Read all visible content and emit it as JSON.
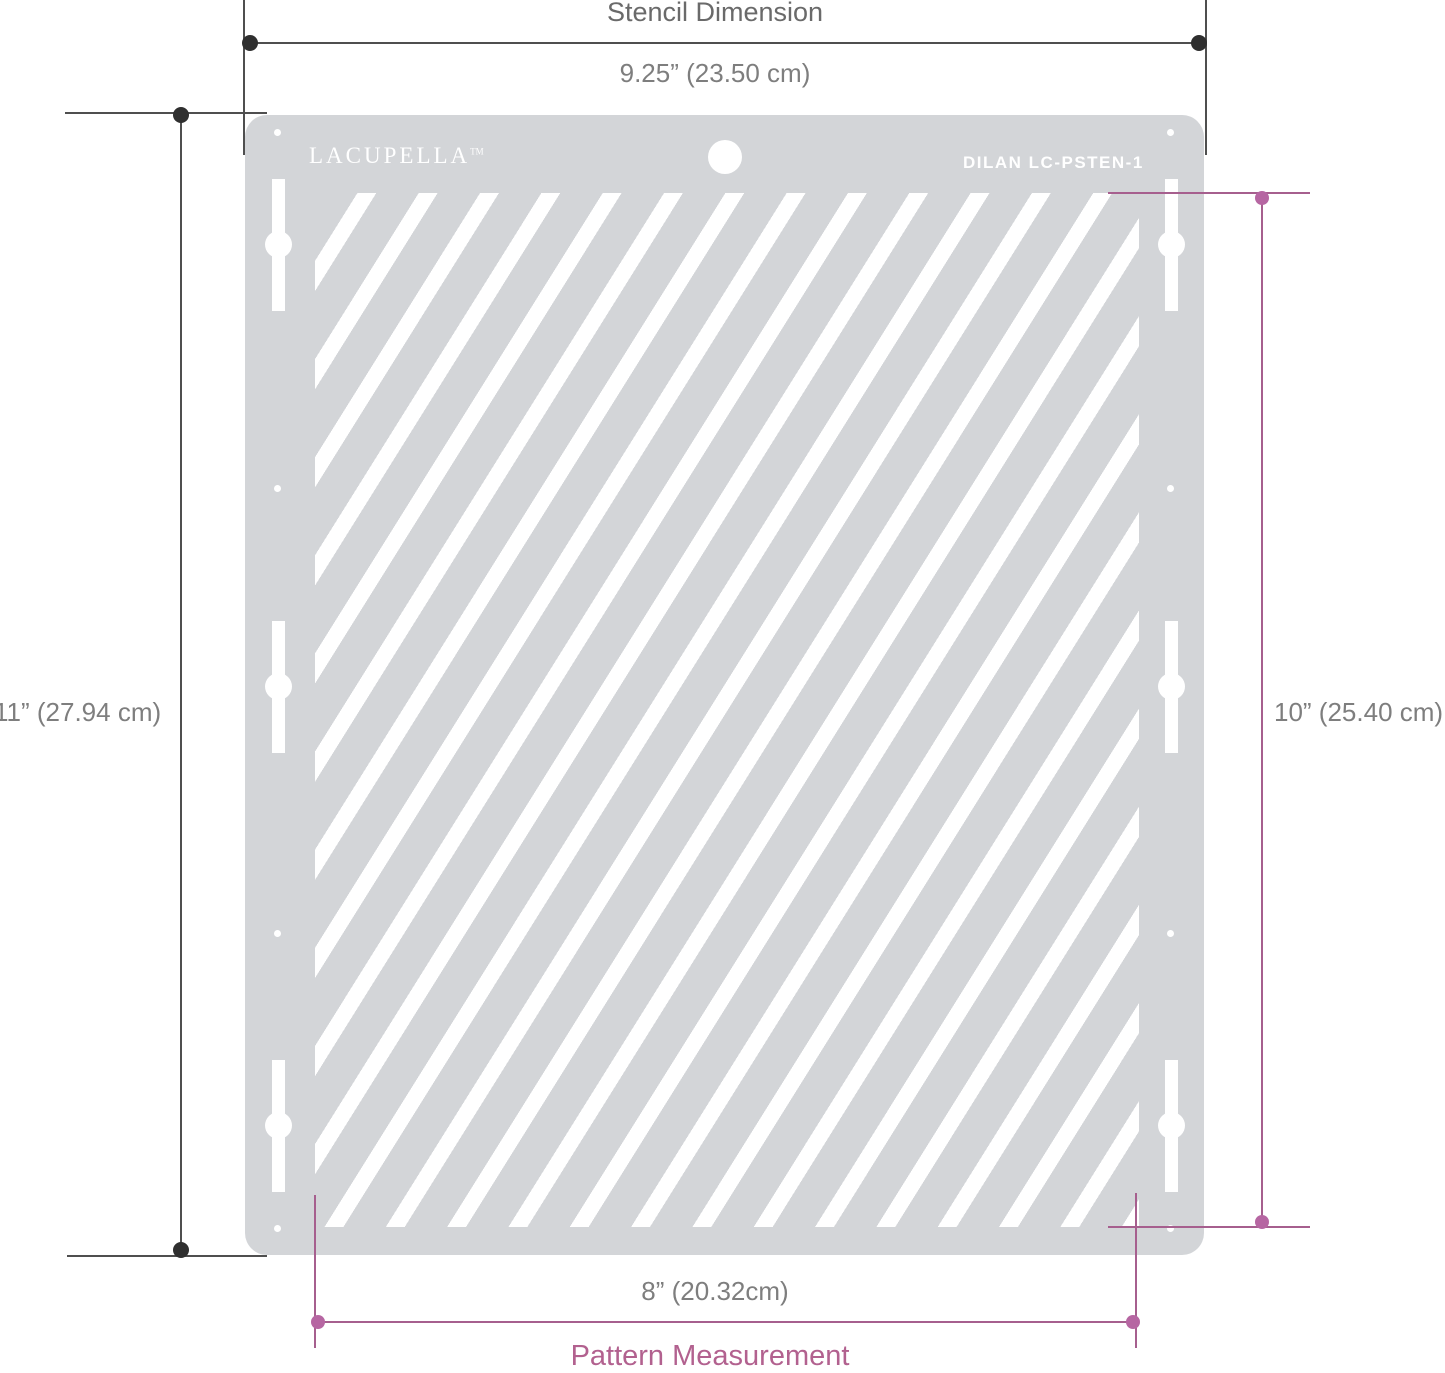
{
  "diagram": {
    "type": "product-dimension-diagram",
    "subject": "cake decorating stripe stencil"
  },
  "stencil": {
    "brand": "LACUPELLA",
    "brand_mark": "TM",
    "product_code": "DILAN  LC-PSTEN-1",
    "pattern": "diagonal-stripes",
    "body_color": "#d3d5d8",
    "cutout_color": "#ffffff"
  },
  "labels": {
    "top_title": "Stencil Dimension",
    "top_value": "9.25” (23.50 cm)",
    "left_value": "11” (27.94 cm)",
    "right_value": "10” (25.40 cm)",
    "bottom_value": "8” (20.32cm)",
    "bottom_title": "Pattern Measurement"
  },
  "measurements": {
    "stencil_width": "9.25 in / 23.50 cm",
    "stencil_height": "11 in / 27.94 cm",
    "pattern_width": "8 in / 20.32 cm",
    "pattern_height": "10 in / 25.40 cm"
  },
  "colors": {
    "stencil_dimension_lines": "#4f4f4f",
    "stencil_dimension_dots": "#2f2f2f",
    "pattern_dimension_lines": "#a65f8e",
    "pattern_dimension_dots": "#b666a2",
    "value_text": "#7e7e7e",
    "top_title_text": "#6a6a6a",
    "bottom_title_text": "#b2618f"
  }
}
